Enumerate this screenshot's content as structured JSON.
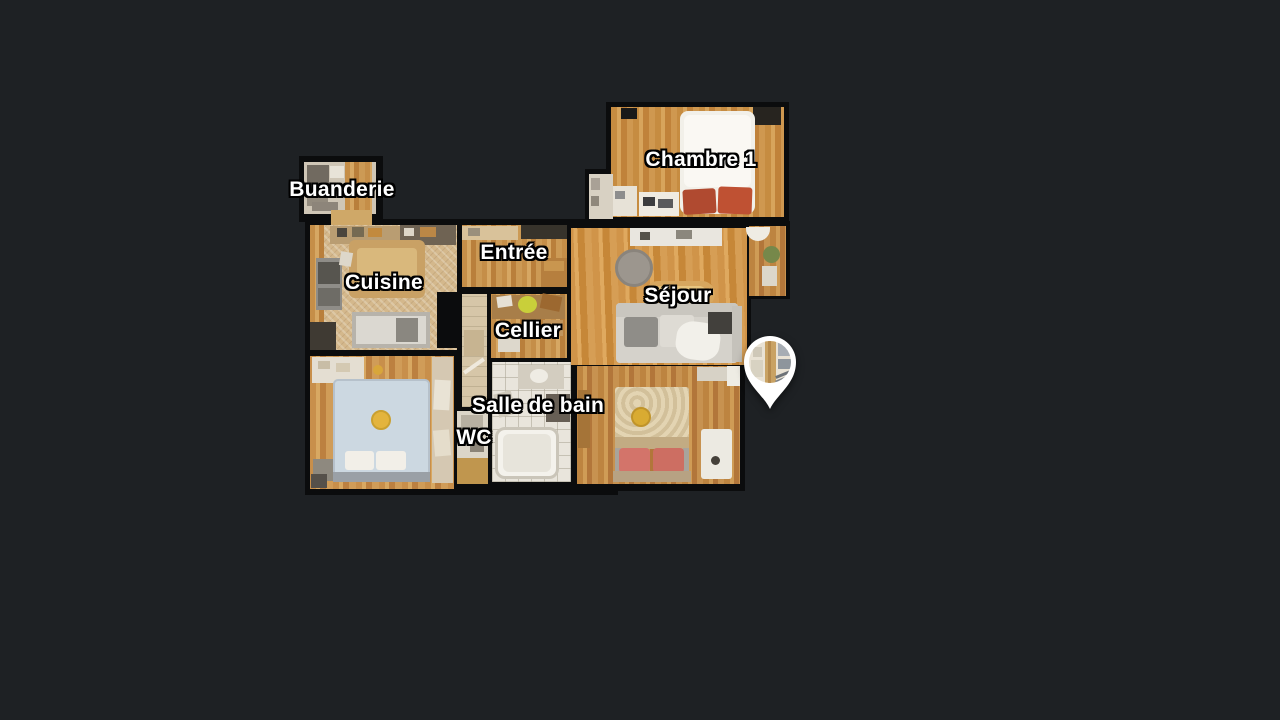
{
  "view": {
    "name": "floorplan-dollhouse-view"
  },
  "theme": {
    "bg": "#1e2124",
    "wall": "#0b0c0d",
    "label-color": "#ffffff",
    "label-outline": "#000000",
    "pin-color": "#ffffff",
    "wood-main": "#c98f45",
    "bathroom-tile": "#e9e5dc",
    "kitchen-tile": "#d4b88c",
    "bed-red-pillow": "#b54a31",
    "bed-blue-cover": "#ccd8e1",
    "bed-pink-pillow": "#d3746a",
    "accent-yellow": "#ddae35"
  },
  "floorplan": {
    "rooms": [
      {
        "id": "buanderie",
        "label": "Buanderie"
      },
      {
        "id": "chambre-1",
        "label": "Chambre 1"
      },
      {
        "id": "cuisine",
        "label": "Cuisine"
      },
      {
        "id": "entree",
        "label": "Entrée"
      },
      {
        "id": "sejour",
        "label": "Séjour"
      },
      {
        "id": "cellier",
        "label": "Cellier"
      },
      {
        "id": "salle-de-bain",
        "label": "Salle de bain"
      },
      {
        "id": "wc",
        "label": "WC"
      }
    ],
    "marker": {
      "id": "panorama-pin",
      "shape": "teardrop",
      "color": "#ffffff"
    }
  }
}
